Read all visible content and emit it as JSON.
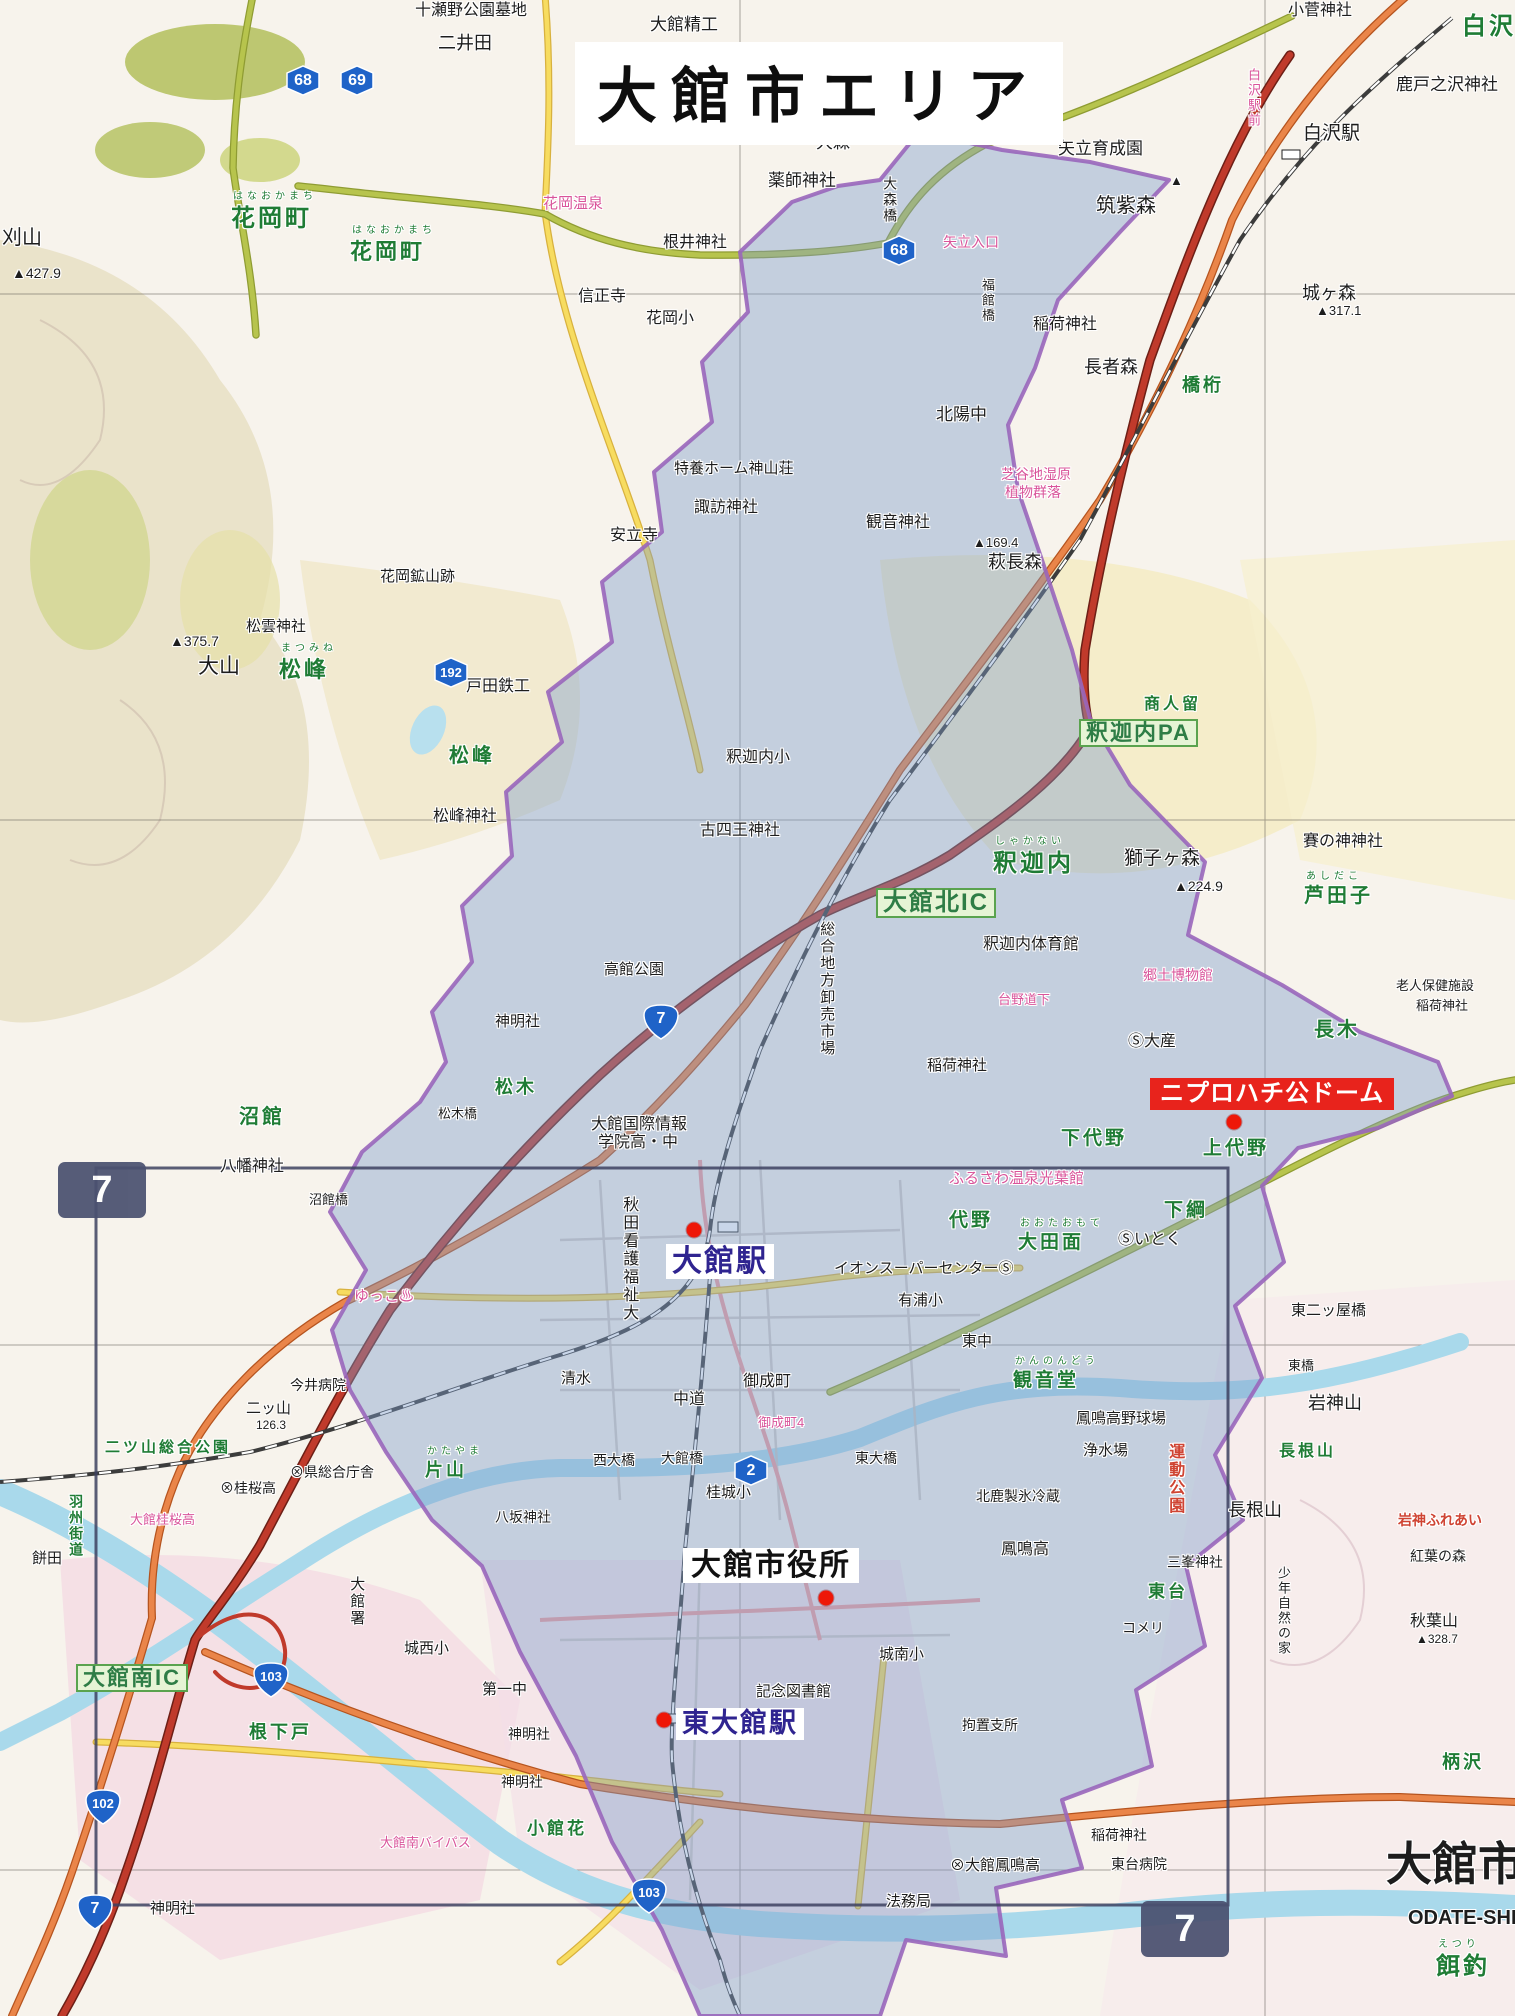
{
  "title": {
    "text": "大館市エリア"
  },
  "callouts": [
    {
      "id": "dome-label",
      "text": "ニプロハチ公ドーム",
      "style": "red-box",
      "x": 1150,
      "y": 1078,
      "fs": 24
    },
    {
      "id": "odate-station-label",
      "text": "大館駅",
      "style": "station",
      "x": 666,
      "y": 1244,
      "fs": 30
    },
    {
      "id": "city-hall-label",
      "text": "大館市役所",
      "style": "plain-box",
      "x": 683,
      "y": 1548,
      "fs": 30
    },
    {
      "id": "higashi-odate-station-label",
      "text": "東大館駅",
      "style": "station",
      "x": 676,
      "y": 1708,
      "fs": 27
    }
  ],
  "dots": [
    {
      "x": 694,
      "y": 1230
    },
    {
      "x": 1234,
      "y": 1122
    },
    {
      "x": 826,
      "y": 1598
    },
    {
      "x": 664,
      "y": 1720
    }
  ],
  "page_markers": [
    {
      "n": "7",
      "x": 58,
      "y": 1162
    },
    {
      "n": "7",
      "x": 1141,
      "y": 1901
    }
  ],
  "shields": [
    {
      "n": "68",
      "type": "pref",
      "x": 282,
      "y": 62
    },
    {
      "n": "69",
      "type": "pref",
      "x": 336,
      "y": 62
    },
    {
      "n": "68",
      "type": "pref",
      "x": 878,
      "y": 232
    },
    {
      "n": "192",
      "type": "pref",
      "x": 430,
      "y": 654
    },
    {
      "n": "7",
      "type": "nat",
      "x": 640,
      "y": 1002
    },
    {
      "n": "2",
      "type": "pref",
      "x": 730,
      "y": 1452
    },
    {
      "n": "103",
      "type": "nat",
      "x": 250,
      "y": 1660
    },
    {
      "n": "102",
      "type": "nat",
      "x": 82,
      "y": 1787
    },
    {
      "n": "103",
      "type": "nat",
      "x": 628,
      "y": 1876
    },
    {
      "n": "7",
      "type": "nat",
      "x": 74,
      "y": 1892
    }
  ],
  "labels": [
    {
      "t": "十瀬野公園墓地",
      "x": 415,
      "y": 2,
      "c": "k",
      "s": 16
    },
    {
      "t": "大館精工",
      "x": 650,
      "y": 16,
      "c": "k",
      "s": 17
    },
    {
      "t": "二井田",
      "x": 438,
      "y": 34,
      "c": "k",
      "s": 18
    },
    {
      "t": "小菅神社",
      "x": 1288,
      "y": 2,
      "c": "k",
      "s": 16
    },
    {
      "t": "白沢",
      "x": 1462,
      "y": 14,
      "c": "g",
      "s": 24
    },
    {
      "t": "鹿戸之沢神社",
      "x": 1396,
      "y": 76,
      "c": "k",
      "s": 17
    },
    {
      "t": "白沢駅",
      "x": 1303,
      "y": 124,
      "c": "k",
      "s": 19
    },
    {
      "t": "白沢駅前",
      "x": 1246,
      "y": 68,
      "c": "p",
      "s": 13,
      "v": 1
    },
    {
      "t": "矢立育成園",
      "x": 1058,
      "y": 140,
      "c": "k",
      "s": 17
    },
    {
      "t": "大森",
      "x": 816,
      "y": 134,
      "c": "k",
      "s": 17
    },
    {
      "t": "薬師神社",
      "x": 768,
      "y": 172,
      "c": "k",
      "s": 17
    },
    {
      "t": "大森橋",
      "x": 882,
      "y": 176,
      "c": "k",
      "s": 14,
      "v": 1
    },
    {
      "t": "筑紫森",
      "x": 1096,
      "y": 196,
      "c": "k",
      "s": 20
    },
    {
      "t": "▲",
      "x": 1170,
      "y": 174,
      "c": "k",
      "s": 13
    },
    {
      "t": "矢立入口",
      "x": 943,
      "y": 235,
      "c": "p",
      "s": 14
    },
    {
      "t": "花岡温泉",
      "x": 543,
      "y": 196,
      "c": "p",
      "s": 15
    },
    {
      "t": "根井神社",
      "x": 663,
      "y": 234,
      "c": "k",
      "s": 16
    },
    {
      "t": "花岡町",
      "x": 231,
      "y": 206,
      "c": "g",
      "s": 24,
      "f": "はなおかまち"
    },
    {
      "t": "花岡町",
      "x": 350,
      "y": 240,
      "c": "g",
      "s": 22,
      "f": "はなおかまち"
    },
    {
      "t": "刈山",
      "x": 2,
      "y": 228,
      "c": "k",
      "s": 20
    },
    {
      "t": "▲427.9",
      "x": 12,
      "y": 266,
      "c": "k",
      "s": 14
    },
    {
      "t": "信正寺",
      "x": 578,
      "y": 288,
      "c": "k",
      "s": 16
    },
    {
      "t": "花岡小",
      "x": 646,
      "y": 310,
      "c": "k",
      "s": 16
    },
    {
      "t": "北陽中",
      "x": 936,
      "y": 406,
      "c": "k",
      "s": 17
    },
    {
      "t": "長者森",
      "x": 1084,
      "y": 358,
      "c": "k",
      "s": 18
    },
    {
      "t": "橋桁",
      "x": 1182,
      "y": 376,
      "c": "g",
      "s": 18
    },
    {
      "t": "城ヶ森",
      "x": 1302,
      "y": 284,
      "c": "k",
      "s": 18
    },
    {
      "t": "▲317.1",
      "x": 1316,
      "y": 304,
      "c": "k",
      "s": 13
    },
    {
      "t": "稲荷神社",
      "x": 1033,
      "y": 316,
      "c": "k",
      "s": 16
    },
    {
      "t": "福館橋",
      "x": 980,
      "y": 278,
      "c": "k",
      "s": 13,
      "v": 1
    },
    {
      "t": "特養ホーム神山荘",
      "x": 674,
      "y": 461,
      "c": "k",
      "s": 15
    },
    {
      "t": "諏訪神社",
      "x": 694,
      "y": 499,
      "c": "k",
      "s": 16
    },
    {
      "t": "観音神社",
      "x": 866,
      "y": 514,
      "c": "k",
      "s": 16
    },
    {
      "t": "芝谷地湿原",
      "x": 1001,
      "y": 467,
      "c": "p",
      "s": 14
    },
    {
      "t": "植物群落",
      "x": 1005,
      "y": 485,
      "c": "p",
      "s": 14
    },
    {
      "t": "▲169.4",
      "x": 973,
      "y": 536,
      "c": "k",
      "s": 13
    },
    {
      "t": "萩長森",
      "x": 988,
      "y": 553,
      "c": "k",
      "s": 18
    },
    {
      "t": "安立寺",
      "x": 610,
      "y": 527,
      "c": "k",
      "s": 16
    },
    {
      "t": "花岡鉱山跡",
      "x": 380,
      "y": 569,
      "c": "k",
      "s": 15
    },
    {
      "t": "松雲神社",
      "x": 246,
      "y": 619,
      "c": "k",
      "s": 15
    },
    {
      "t": "▲375.7",
      "x": 170,
      "y": 634,
      "c": "k",
      "s": 14
    },
    {
      "t": "大山",
      "x": 198,
      "y": 656,
      "c": "k",
      "s": 21
    },
    {
      "t": "松峰",
      "x": 279,
      "y": 658,
      "c": "g",
      "s": 22,
      "f": "まつみね"
    },
    {
      "t": "戸田鉄工",
      "x": 466,
      "y": 678,
      "c": "k",
      "s": 16
    },
    {
      "t": "松峰",
      "x": 449,
      "y": 746,
      "c": "g",
      "s": 20
    },
    {
      "t": "松峰神社",
      "x": 433,
      "y": 808,
      "c": "k",
      "s": 16
    },
    {
      "t": "釈迦内小",
      "x": 726,
      "y": 749,
      "c": "k",
      "s": 16
    },
    {
      "t": "古四王神社",
      "x": 700,
      "y": 822,
      "c": "k",
      "s": 16
    },
    {
      "t": "沼館",
      "x": 239,
      "y": 1107,
      "c": "g",
      "s": 20
    },
    {
      "t": "神明社",
      "x": 495,
      "y": 1014,
      "c": "k",
      "s": 15
    },
    {
      "t": "高館公園",
      "x": 604,
      "y": 962,
      "c": "k",
      "s": 15
    },
    {
      "t": "松木",
      "x": 495,
      "y": 1078,
      "c": "g",
      "s": 18
    },
    {
      "t": "松木橋",
      "x": 438,
      "y": 1107,
      "c": "k",
      "s": 13
    },
    {
      "t": "釈迦内",
      "x": 993,
      "y": 851,
      "c": "g",
      "s": 24,
      "f": "しゃかない"
    },
    {
      "t": "大館北IC",
      "x": 876,
      "y": 888,
      "c": "gbox",
      "s": 24
    },
    {
      "t": "釈迦内体育館",
      "x": 983,
      "y": 936,
      "c": "k",
      "s": 16
    },
    {
      "t": "総合地方卸売市場",
      "x": 818,
      "y": 921,
      "c": "k",
      "s": 15,
      "v": 1
    },
    {
      "t": "商人留",
      "x": 1144,
      "y": 696,
      "c": "g",
      "s": 16
    },
    {
      "t": "釈迦内PA",
      "x": 1079,
      "y": 719,
      "c": "gbox",
      "s": 22
    },
    {
      "t": "獅子ヶ森",
      "x": 1124,
      "y": 849,
      "c": "k",
      "s": 19
    },
    {
      "t": "▲224.9",
      "x": 1174,
      "y": 879,
      "c": "k",
      "s": 14
    },
    {
      "t": "賽の神神社",
      "x": 1303,
      "y": 833,
      "c": "k",
      "s": 16
    },
    {
      "t": "芦田子",
      "x": 1304,
      "y": 886,
      "c": "g",
      "s": 20,
      "f": "あしだこ"
    },
    {
      "t": "老人保健施設",
      "x": 1396,
      "y": 979,
      "c": "k",
      "s": 13
    },
    {
      "t": "稲荷神社",
      "x": 1416,
      "y": 999,
      "c": "k",
      "s": 13
    },
    {
      "t": "長木",
      "x": 1314,
      "y": 1020,
      "c": "g",
      "s": 20
    },
    {
      "t": "郷土博物館",
      "x": 1143,
      "y": 968,
      "c": "p",
      "s": 14
    },
    {
      "t": "台野道下",
      "x": 998,
      "y": 993,
      "c": "p",
      "s": 13
    },
    {
      "t": "Ⓢ大産",
      "x": 1128,
      "y": 1033,
      "c": "k",
      "s": 16
    },
    {
      "t": "稲荷神社",
      "x": 927,
      "y": 1058,
      "c": "k",
      "s": 15
    },
    {
      "t": "下代野",
      "x": 1061,
      "y": 1129,
      "c": "g",
      "s": 19
    },
    {
      "t": "上代野",
      "x": 1203,
      "y": 1139,
      "c": "g",
      "s": 19
    },
    {
      "t": "ふるさわ温泉光葉館",
      "x": 949,
      "y": 1171,
      "c": "p",
      "s": 15
    },
    {
      "t": "代野",
      "x": 949,
      "y": 1211,
      "c": "g",
      "s": 19
    },
    {
      "t": "大田面",
      "x": 1018,
      "y": 1233,
      "c": "g",
      "s": 19,
      "f": "おおたおもて"
    },
    {
      "t": "Ⓢいとく",
      "x": 1118,
      "y": 1231,
      "c": "k",
      "s": 16
    },
    {
      "t": "下綱",
      "x": 1164,
      "y": 1201,
      "c": "g",
      "s": 19
    },
    {
      "t": "東二ッ屋橋",
      "x": 1291,
      "y": 1303,
      "c": "k",
      "s": 15
    },
    {
      "t": "イオンスーパーセンターⓈ",
      "x": 834,
      "y": 1261,
      "c": "k",
      "s": 15
    },
    {
      "t": "有浦小",
      "x": 898,
      "y": 1293,
      "c": "k",
      "s": 15
    },
    {
      "t": "東中",
      "x": 962,
      "y": 1334,
      "c": "k",
      "s": 15
    },
    {
      "t": "大館国際情報",
      "x": 591,
      "y": 1116,
      "c": "k",
      "s": 16
    },
    {
      "t": "学院高・中",
      "x": 598,
      "y": 1134,
      "c": "k",
      "s": 16
    },
    {
      "t": "八幡神社",
      "x": 220,
      "y": 1158,
      "c": "k",
      "s": 16
    },
    {
      "t": "沼館橋",
      "x": 309,
      "y": 1193,
      "c": "k",
      "s": 13
    },
    {
      "t": "ゆっこ♨",
      "x": 354,
      "y": 1289,
      "c": "p",
      "s": 15
    },
    {
      "t": "今井病院",
      "x": 290,
      "y": 1378,
      "c": "k",
      "s": 14
    },
    {
      "t": "二ッ山",
      "x": 246,
      "y": 1401,
      "c": "k",
      "s": 15
    },
    {
      "t": "126.3",
      "x": 256,
      "y": 1419,
      "c": "k",
      "s": 12
    },
    {
      "t": "二ツ山総合公園",
      "x": 105,
      "y": 1440,
      "c": "g",
      "s": 15
    },
    {
      "t": "羽州街道",
      "x": 68,
      "y": 1494,
      "c": "g",
      "s": 14,
      "v": 1
    },
    {
      "t": "餅田",
      "x": 32,
      "y": 1551,
      "c": "k",
      "s": 15
    },
    {
      "t": "⊗県総合庁舎",
      "x": 290,
      "y": 1465,
      "c": "k",
      "s": 14
    },
    {
      "t": "⊗桂桜高",
      "x": 220,
      "y": 1481,
      "c": "k",
      "s": 14
    },
    {
      "t": "大館桂桜高",
      "x": 130,
      "y": 1513,
      "c": "p",
      "s": 13
    },
    {
      "t": "片山",
      "x": 425,
      "y": 1461,
      "c": "g",
      "s": 18,
      "f": "かたやま"
    },
    {
      "t": "八坂神社",
      "x": 495,
      "y": 1510,
      "c": "k",
      "s": 14
    },
    {
      "t": "清水",
      "x": 561,
      "y": 1371,
      "c": "k",
      "s": 15
    },
    {
      "t": "中道",
      "x": 673,
      "y": 1391,
      "c": "k",
      "s": 16
    },
    {
      "t": "御成町",
      "x": 743,
      "y": 1373,
      "c": "k",
      "s": 16
    },
    {
      "t": "御成町4",
      "x": 758,
      "y": 1416,
      "c": "p",
      "s": 13
    },
    {
      "t": "西大橋",
      "x": 593,
      "y": 1453,
      "c": "k",
      "s": 14
    },
    {
      "t": "大館橋",
      "x": 661,
      "y": 1451,
      "c": "k",
      "s": 14
    },
    {
      "t": "東大橋",
      "x": 855,
      "y": 1451,
      "c": "k",
      "s": 14
    },
    {
      "t": "桂城小",
      "x": 706,
      "y": 1485,
      "c": "k",
      "s": 15
    },
    {
      "t": "北鹿製氷冷蔵",
      "x": 976,
      "y": 1489,
      "c": "k",
      "s": 14
    },
    {
      "t": "観音堂",
      "x": 1013,
      "y": 1371,
      "c": "g",
      "s": 19,
      "f": "かんのんどう"
    },
    {
      "t": "鳳鳴高野球場",
      "x": 1076,
      "y": 1411,
      "c": "k",
      "s": 15
    },
    {
      "t": "浄水場",
      "x": 1083,
      "y": 1443,
      "c": "k",
      "s": 15
    },
    {
      "t": "鳳鳴高",
      "x": 1001,
      "y": 1541,
      "c": "k",
      "s": 16
    },
    {
      "t": "運動公園",
      "x": 1166,
      "y": 1443,
      "c": "r",
      "s": 16,
      "v": 1
    },
    {
      "t": "長根山",
      "x": 1279,
      "y": 1443,
      "c": "g",
      "s": 16
    },
    {
      "t": "長根山",
      "x": 1228,
      "y": 1501,
      "c": "k",
      "s": 18
    },
    {
      "t": "岩神山",
      "x": 1308,
      "y": 1394,
      "c": "k",
      "s": 18
    },
    {
      "t": "東橋",
      "x": 1288,
      "y": 1359,
      "c": "k",
      "s": 13
    },
    {
      "t": "岩神ふれあい",
      "x": 1398,
      "y": 1513,
      "c": "r",
      "s": 14
    },
    {
      "t": "紅葉の森",
      "x": 1410,
      "y": 1549,
      "c": "k",
      "s": 14
    },
    {
      "t": "秋葉山",
      "x": 1410,
      "y": 1613,
      "c": "k",
      "s": 16
    },
    {
      "t": "▲328.7",
      "x": 1416,
      "y": 1633,
      "c": "k",
      "s": 12
    },
    {
      "t": "柄沢",
      "x": 1442,
      "y": 1753,
      "c": "g",
      "s": 18
    },
    {
      "t": "三峯神社",
      "x": 1167,
      "y": 1555,
      "c": "k",
      "s": 14
    },
    {
      "t": "少年自然の家",
      "x": 1276,
      "y": 1566,
      "c": "k",
      "s": 13,
      "v": 1
    },
    {
      "t": "東台",
      "x": 1148,
      "y": 1583,
      "c": "g",
      "s": 17
    },
    {
      "t": "コメリ",
      "x": 1122,
      "y": 1621,
      "c": "k",
      "s": 14
    },
    {
      "t": "城南小",
      "x": 879,
      "y": 1647,
      "c": "k",
      "s": 15
    },
    {
      "t": "拘置支所",
      "x": 962,
      "y": 1718,
      "c": "k",
      "s": 14
    },
    {
      "t": "記念図書館",
      "x": 756,
      "y": 1684,
      "c": "k",
      "s": 15
    },
    {
      "t": "第一中",
      "x": 482,
      "y": 1682,
      "c": "k",
      "s": 15
    },
    {
      "t": "城西小",
      "x": 404,
      "y": 1641,
      "c": "k",
      "s": 15
    },
    {
      "t": "大館署",
      "x": 348,
      "y": 1576,
      "c": "k",
      "s": 15,
      "v": 1
    },
    {
      "t": "神明社",
      "x": 508,
      "y": 1727,
      "c": "k",
      "s": 14
    },
    {
      "t": "神明社",
      "x": 501,
      "y": 1775,
      "c": "k",
      "s": 14
    },
    {
      "t": "神明社",
      "x": 150,
      "y": 1901,
      "c": "k",
      "s": 15
    },
    {
      "t": "小館花",
      "x": 527,
      "y": 1820,
      "c": "g",
      "s": 17
    },
    {
      "t": "根下戸",
      "x": 249,
      "y": 1723,
      "c": "g",
      "s": 18
    },
    {
      "t": "大館南IC",
      "x": 76,
      "y": 1664,
      "c": "gbox",
      "s": 22
    },
    {
      "t": "大館南バイパス",
      "x": 380,
      "y": 1836,
      "c": "p",
      "s": 13
    },
    {
      "t": "⊗大館鳳鳴高",
      "x": 950,
      "y": 1858,
      "c": "k",
      "s": 15
    },
    {
      "t": "稲荷神社",
      "x": 1091,
      "y": 1828,
      "c": "k",
      "s": 14
    },
    {
      "t": "東台病院",
      "x": 1111,
      "y": 1857,
      "c": "k",
      "s": 14
    },
    {
      "t": "法務局",
      "x": 886,
      "y": 1894,
      "c": "k",
      "s": 15
    },
    {
      "t": "秋田看護福祉大",
      "x": 620,
      "y": 1196,
      "c": "k",
      "s": 16,
      "v": 1
    },
    {
      "t": "大館市",
      "x": 1386,
      "y": 1840,
      "c": "k",
      "s": 46,
      "b": 1
    },
    {
      "t": "ODATE-SHI",
      "x": 1408,
      "y": 1908,
      "c": "k",
      "s": 20,
      "b": 1
    },
    {
      "t": "餌釣",
      "x": 1436,
      "y": 1954,
      "c": "g",
      "s": 24,
      "f": "えつり"
    }
  ],
  "colors": {
    "area_fill": "#7f9ecb",
    "boundary": "#9966bb",
    "expressway": "#c03a2b",
    "national_route": "#ea8549",
    "prefectural_route": "#b7c44d",
    "route_shield": "#1f63c8",
    "dome_label_bg": "#e8231c",
    "station_text": "#2f2490",
    "water": "#a9d9eb",
    "page_marker_bg": "#4a5170"
  }
}
